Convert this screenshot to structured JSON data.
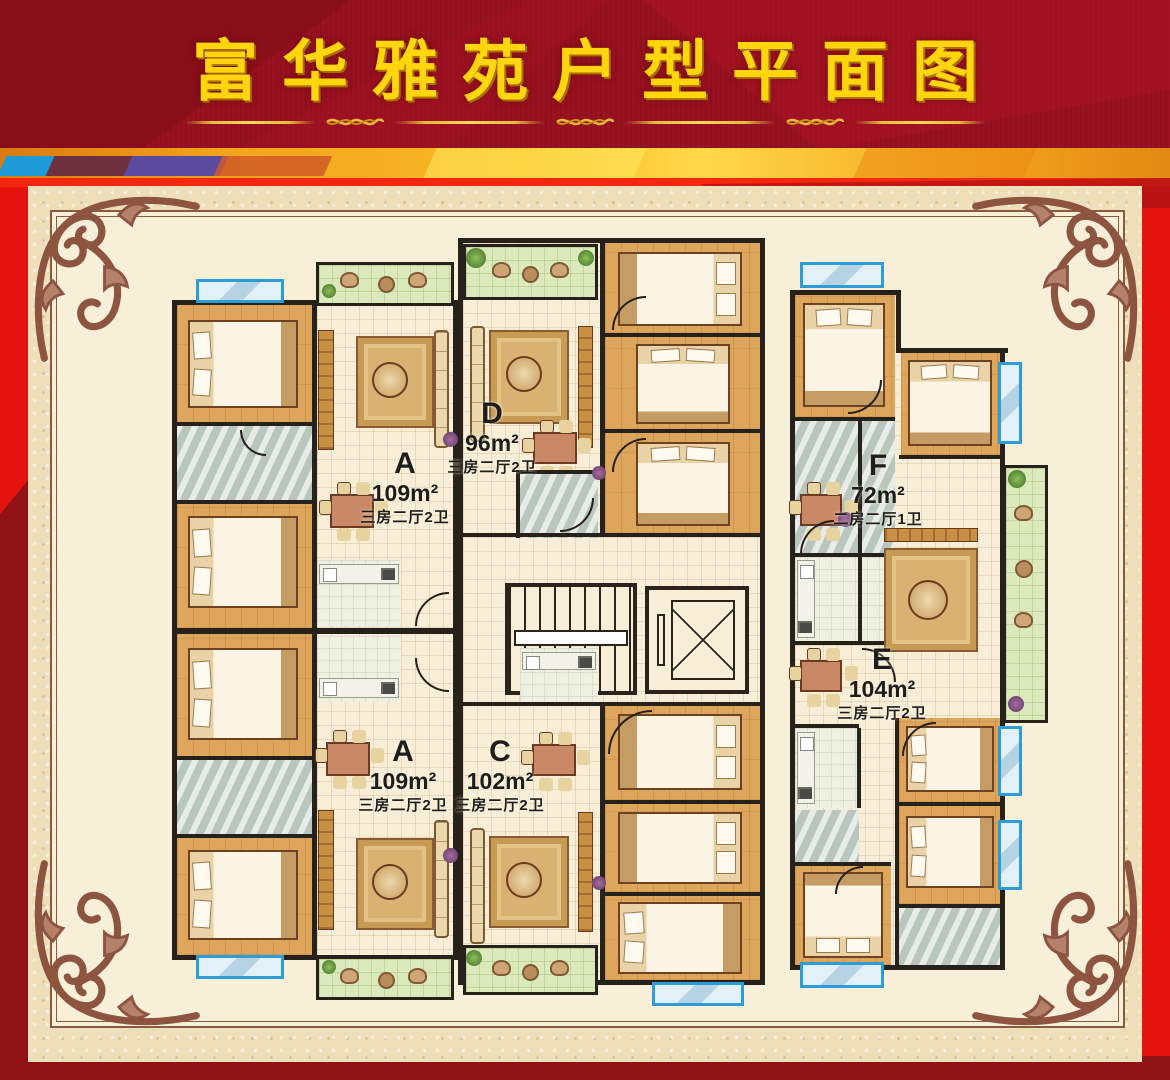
{
  "header": {
    "title": "富华雅苑户型平面图"
  },
  "units": [
    {
      "id": "A",
      "area": "109m²",
      "spec": "三房二厅2卫",
      "location": "upper-left"
    },
    {
      "id": "D",
      "area": "96m²",
      "spec": "三房二厅2卫",
      "location": "upper-middle"
    },
    {
      "id": "C",
      "area": "102m²",
      "spec": "三房二厅2卫",
      "location": "lower-middle"
    },
    {
      "id": "A",
      "area": "109m²",
      "spec": "三房二厅2卫",
      "location": "lower-left"
    },
    {
      "id": "F",
      "area": "72m²",
      "spec": "二房二厅1卫",
      "location": "upper-right"
    },
    {
      "id": "E",
      "area": "104m²",
      "spec": "三房二厅2卫",
      "location": "lower-right"
    }
  ],
  "core": {
    "features": [
      "stairs",
      "elevator"
    ]
  },
  "icons": {
    "stairs-icon": "striped-steps-with-rail",
    "elevator-icon": "square-with-x",
    "window-icon": "blue-glass-strip",
    "balcony-icon": "green-grid-strip",
    "plant-icon": "green-dot",
    "flower-icon": "purple-dot",
    "corner-flourish-icon": "baroque-scroll",
    "divider-ornament-icon": "gold-braid"
  },
  "colors": {
    "banner_red": "#9a1120",
    "banner_dark_red": "#860d1a",
    "title_gold": "#ffd60e",
    "stripe_orange": "#f2a21c",
    "stripe_yellow": "#ffd84a",
    "stripe_blue": "#1d9cd8",
    "stripe_purple": "#5c4a9e",
    "body_red": "#e6140e",
    "maroon": "#8e1216",
    "panel_cream": "#eedfba",
    "plan_cream": "#f8efd8",
    "frame_brown": "#8a5a3c",
    "wall_black": "#27211b",
    "wood_floor": "#dea65c",
    "bath_gray": "#ccd6cf",
    "balcony_green": "#dce9bc",
    "window_blue": "#2e9cd6"
  }
}
